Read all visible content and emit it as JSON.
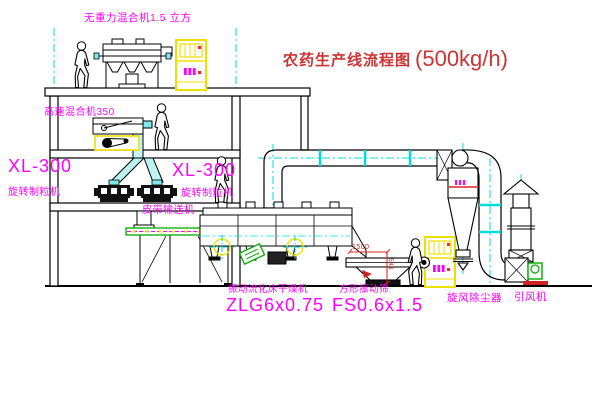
{
  "title": {
    "text": "农药生产线流程图",
    "capacity": "(500kg/h)"
  },
  "labels": {
    "gravity_mixer": "无重力混合机1.5 立方",
    "high_speed_mixer": "高速混合机350",
    "granulator_left_model": "XL-300",
    "granulator_left_name": "旋转制粒机",
    "granulator_right_model": "XL-300",
    "granulator_right_name": "旋转制粒机",
    "belt_conveyor": "皮带输送机",
    "dryer_name": "振动流化床干燥机",
    "dryer_model": "ZLG6x0.75",
    "screen_name": "方形振动筛",
    "screen_model": "FS0.6x1.5",
    "cyclone": "旋风除尘器",
    "fan": "引风机"
  },
  "dimensions": {
    "screen_length": "1500",
    "screen_height": "541"
  },
  "colors": {
    "label": "#ff00ff",
    "title": "#cc3333",
    "dimension": "#dd2222",
    "cabinet": "#ede000",
    "centerline": "#00dcdc",
    "accent_green": "#00aa00",
    "line": "#000000"
  }
}
